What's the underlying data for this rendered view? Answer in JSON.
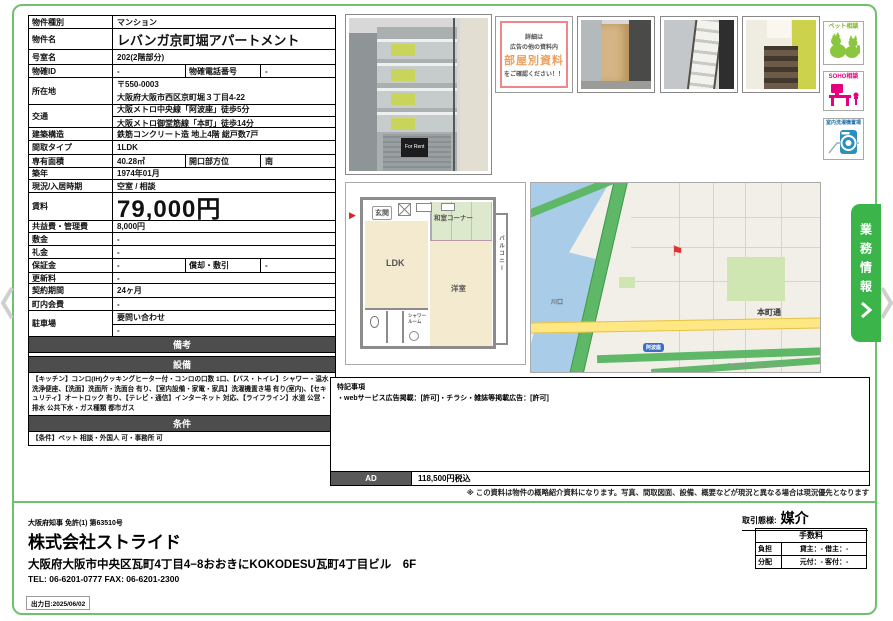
{
  "colors": {
    "frame_green": "#6fc06f",
    "tab_green": "#3bb54a",
    "pet_green": "#8cc63f",
    "soho_magenta": "#e6007e",
    "washer_blue": "#2b8fbf",
    "flag_red": "#e03030",
    "section_gray": "#4d4d4d"
  },
  "table": {
    "rows": [
      {
        "label": "物件種別",
        "value": "マンション"
      },
      {
        "label": "物件名",
        "value": "レバンガ京町堀アパートメント"
      },
      {
        "label": "号室名",
        "value": "202(2階部分)"
      },
      {
        "label": "物確ID",
        "value": "-",
        "label2": "物確電話番号",
        "value2": "-"
      },
      {
        "label": "所在地",
        "line1": "〒550-0003",
        "line2": "大阪府大阪市西区京町堀３丁目4-22"
      },
      {
        "label": "交通",
        "line1": "大阪メトロ中央線「阿波座」徒歩5分",
        "line2": "大阪メトロ御堂筋線「本町」徒歩14分"
      },
      {
        "label": "建築構造",
        "value": "鉄筋コンクリート造 地上4階 総戸数7戸"
      },
      {
        "label": "間取タイプ",
        "value": "1LDK"
      },
      {
        "label": "専有面積",
        "value": "40.28㎡",
        "label2": "開口部方位",
        "value2": "南"
      },
      {
        "label": "築年",
        "value": "1974年01月"
      },
      {
        "label": "現況/入居時期",
        "value": "空室 / 相談"
      },
      {
        "label": "賃料",
        "value": "79,000円"
      },
      {
        "label": "共益費・管理費",
        "value": "8,000円"
      },
      {
        "label": "敷金",
        "value": "-"
      },
      {
        "label": "礼金",
        "value": "-"
      },
      {
        "label": "保証金",
        "value": "-",
        "label2": "償却・敷引",
        "value2": "-"
      },
      {
        "label": "更新料",
        "value": "-"
      },
      {
        "label": "契約期間",
        "value": "24ヶ月"
      },
      {
        "label": "町内会費",
        "value": "-"
      },
      {
        "label": "駐車場",
        "line1": "要問い合わせ",
        "line2": "-"
      }
    ],
    "sections": {
      "remarks_header": "備考",
      "equipment_header": "設備",
      "equipment_text": "【キッチン】コンロ(IH)クッキングヒーター付・コンロの口数 1口、【バス・トイレ】シャワー・温水洗浄便座、【洗面】洗面所・洗面台 有り、【室内設備・家電・家具】洗濯機置き場 有り(室内)、【セキュリティ】オートロック 有り、【テレビ・通信】インターネット 対応、【ライフライン】水道 公営・排水 公共下水・ガス種類 都市ガス",
      "conditions_header": "条件",
      "conditions_text": "【条件】ペット 相談・外国人 可・事務所 可"
    }
  },
  "info_card": {
    "line1": "詳細は",
    "line2": "広告の他の資料内",
    "line3": "部屋別資料",
    "line4": "をご確認ください！！"
  },
  "photos": {
    "for_rent_sign": "For Rent"
  },
  "side_icons": {
    "pet": "ペット相談",
    "soho": "SOHO相談",
    "washer": "室内洗濯機置場"
  },
  "biz_tab": "業務情報",
  "floorplan": {
    "genkan": "玄関",
    "ldk": "LDK",
    "washitsu": "和室コーナー",
    "yoshitsu": "洋室",
    "balcony": "バルコニー",
    "shower": "シャワールーム"
  },
  "map": {
    "road": "本町通",
    "district": "川口",
    "station": "阿波座",
    "copyright": "Copyright© 2025 ZENRIN"
  },
  "tokki": {
    "title": "特記事項",
    "line": "・webサービス広告掲載：[許可]・チラシ・雑誌等掲載広告：[許可]",
    "ad_label": "AD",
    "ad_value": "118,500円税込"
  },
  "disclaimer": "※ この資料は物件の概略紹介資料になります。写真、間取図面、設備、概要などが現況と異なる場合は現況優先となります",
  "footer": {
    "license": "大阪府知事 免許(1) 第63510号",
    "company": "株式会社ストライド",
    "address": "大阪府大阪市中央区瓦町4丁目4−8おおきにKOKODESU瓦町4丁目ビル　6F",
    "telfax": "TEL: 06-6201-0777 FAX: 06-6201-2300",
    "output_date": "出力日:2025/06/02"
  },
  "deal": {
    "label": "取引態様:",
    "value": "媒介"
  },
  "fees": {
    "header": "手数料",
    "rows": [
      {
        "label": "負担",
        "value": "貸主：- 借主：-"
      },
      {
        "label": "分配",
        "value": "元付：- 客付：-"
      }
    ]
  }
}
